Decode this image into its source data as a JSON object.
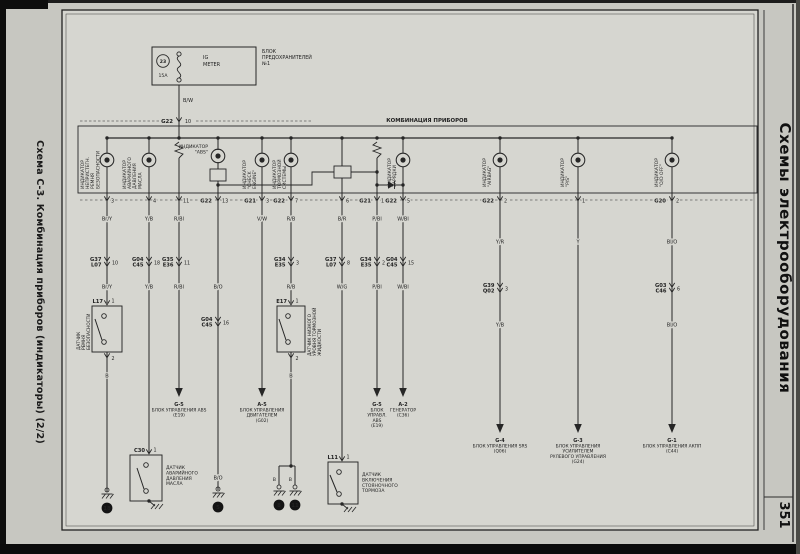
{
  "page": {
    "left_caption": "Схема С-3. Комбинация приборов (индикаторы) (2/2)",
    "right_caption": "Схемы электрооборудования",
    "page_number": "351"
  },
  "colors": {
    "paper": "#c7c7c1",
    "sheet": "#d6d6d0",
    "ink": "#262626"
  },
  "fuse_box": {
    "label_lines": [
      "БЛОК",
      "ПРЕДОХРАНИТЕЛЕЙ",
      "№1"
    ],
    "fuse_id": "23",
    "fuse_rating": "15A",
    "name_lines": [
      "IG",
      "METER"
    ],
    "wire_color": "B/W",
    "connector": "G22",
    "pin": "10"
  },
  "cluster": {
    "label": "КОМБИНАЦИЯ ПРИБОРОВ",
    "indicators": [
      {
        "id": "seatbelt",
        "lines": [
          "ИНДИКАТОР",
          "НЕПРИСТЕГН.",
          "РЕМНЯ",
          "БЕЗОПАСНОСТИ"
        ]
      },
      {
        "id": "oil",
        "lines": [
          "ИНДИКАТОР",
          "АВАРИЙНОГО",
          "ДАВЛЕНИЯ",
          "МАСЛА"
        ]
      },
      {
        "id": "abs",
        "lines": [
          "ИНДИКАТОР",
          "\"ABS\""
        ]
      },
      {
        "id": "check-engine",
        "lines": [
          "ИНДИКАТОР",
          "\"CHECK",
          "ENGINE\""
        ]
      },
      {
        "id": "brake",
        "lines": [
          "ИНДИКАТОР",
          "ТОРМОЗНОЙ",
          "СИСТЕМЫ"
        ]
      },
      {
        "id": "charge",
        "lines": [
          "ИНДИКАТОР",
          "ЗАРЯДКИ"
        ]
      },
      {
        "id": "airbag",
        "lines": [
          "ИНДИКАТОР",
          "\"AIRBAG\""
        ]
      },
      {
        "id": "power-steering",
        "lines": [
          "ИНДИКАТОР",
          "\"P/S\""
        ]
      },
      {
        "id": "od-off",
        "lines": [
          "ИНДИКАТОР",
          "\"O/D OFF\""
        ]
      }
    ]
  },
  "columns": [
    {
      "id": "c1",
      "pin": "3",
      "wire_color_top": "Br/Y",
      "mid_connector": {
        "codes": [
          "G37",
          "L07"
        ],
        "pin": "10"
      },
      "wire_color_mid": "Br/Y",
      "component": {
        "code": "L17",
        "pin_top": "1",
        "pin_bottom": "2",
        "label_lines": [
          "ДАТЧИК",
          "РЕМНЯ",
          "БЕЗОПАСНОСТИ"
        ]
      },
      "wire_color_after": "B",
      "termination": {
        "type": "ground",
        "id": "18"
      }
    },
    {
      "id": "c2",
      "pin": "4",
      "wire_color_top": "Y/B",
      "mid_connector": {
        "codes": [
          "G04",
          "C45"
        ],
        "pin": "18"
      },
      "wire_color_mid": "Y/B",
      "component": {
        "code": "C30",
        "pin_top": "1",
        "label_lines": [
          "ДАТЧИК",
          "АВАРИЙНОГО",
          "ДАВЛЕНИЯ",
          "МАСЛА"
        ]
      },
      "termination": {
        "type": "chassis-ground"
      }
    },
    {
      "id": "c3",
      "pin": "11",
      "wire_color_top": "R/Bl",
      "mid_connector": {
        "codes": [
          "G35",
          "E36"
        ],
        "pin": "11"
      },
      "wire_color_mid": "R/Bl",
      "termination": {
        "type": "arrow",
        "lines": [
          "G-5",
          "БЛОК УПРАВЛЕНИЯ ABS",
          "(E19)"
        ]
      }
    },
    {
      "id": "c4",
      "pin_connector": "G22",
      "pin": "13",
      "wire_color_mid": "B/O",
      "mid_connector": {
        "codes": [
          "G04",
          "C45"
        ],
        "pin": "16"
      },
      "wire_color_after": "B/O",
      "termination": {
        "type": "ground",
        "id": "5"
      }
    },
    {
      "id": "c5",
      "pin_connector": "G21",
      "pin": "3",
      "wire_color_top": "V/W",
      "termination": {
        "type": "arrow",
        "lines": [
          "A-5",
          "БЛОК УПРАВЛЕНИЯ",
          "ДВИГАТЕЛЕМ",
          "(G02)"
        ]
      }
    },
    {
      "id": "c6",
      "pin_connector": "G22",
      "pin": "7",
      "wire_color_top": "R/B",
      "mid_connector": {
        "codes": [
          "G34",
          "E35"
        ],
        "pin": "3"
      },
      "wire_color_mid": "R/B",
      "component": {
        "code": "E17",
        "pin_top": "1",
        "pin_bottom": "2",
        "label_lines": [
          "ДАТЧИК НИЗКОГО",
          "УРОВНЯ ТОРМОЗНОЙ",
          "ЖИДКОСТИ"
        ]
      },
      "wire_color_after": "B",
      "termination": {
        "type": "split-ground",
        "branch_color": "B",
        "ids": [
          "8",
          "11"
        ]
      }
    },
    {
      "id": "c7",
      "pin": "6",
      "wire_color_top": "B/R",
      "mid_connector": {
        "codes": [
          "G37",
          "L07"
        ],
        "pin": "8"
      },
      "wire_color_mid": "W/G",
      "component": {
        "code": "L11",
        "pin_top": "1",
        "label_lines": [
          "ДАТЧИК",
          "ВКЛЮЧЕНИЯ",
          "СТОЯНОЧНОГО",
          "ТОРМОЗА"
        ]
      },
      "termination": {
        "type": "chassis-ground"
      }
    },
    {
      "id": "c8",
      "pin_connector": "G21",
      "pin": "10",
      "wire_color_top": "P/Bl",
      "mid_connector": {
        "codes": [
          "G34",
          "E35"
        ],
        "pin": "2"
      },
      "wire_color_mid": "P/Bl",
      "termination": {
        "type": "arrow",
        "lines": [
          "G-5",
          "БЛОК",
          "УПРАВЛ.",
          "ABS",
          "(E19)"
        ]
      }
    },
    {
      "id": "c9",
      "pin_connector": "G22",
      "pin": "5",
      "wire_color_top": "W/Bl",
      "mid_connector": {
        "codes": [
          "G04",
          "C45"
        ],
        "pin": "15"
      },
      "wire_color_mid": "W/Bl",
      "termination": {
        "type": "arrow",
        "lines": [
          "A-2",
          "ГЕНЕРАТОР",
          "(C36)"
        ]
      }
    },
    {
      "id": "c10",
      "pin_connector": "G22",
      "pin": "2",
      "wire_color_top": "Y/R",
      "mid_connector": {
        "codes": [
          "G39",
          "Q02"
        ],
        "pin": "3"
      },
      "wire_color_mid": "Y/B",
      "termination": {
        "type": "arrow",
        "lines": [
          "G-4",
          "БЛОК УПРАВЛЕНИЯ SRS",
          "(Q06)"
        ]
      }
    },
    {
      "id": "c11",
      "pin": "1",
      "wire_color_top": "Y",
      "termination": {
        "type": "arrow",
        "lines": [
          "G-3",
          "БЛОК УПРАВЛЕНИЯ",
          "УСИЛИТЕЛЕМ",
          "РУЛЕВОГО УПРАВЛЕНИЯ",
          "(G24)"
        ]
      }
    },
    {
      "id": "c12",
      "pin_connector": "G20",
      "pin": "2",
      "wire_color_top": "Bl/O",
      "mid_connector": {
        "codes": [
          "G03",
          "C46"
        ],
        "pin": "6"
      },
      "wire_color_mid": "Bl/O",
      "termination": {
        "type": "arrow",
        "lines": [
          "G-1",
          "БЛОК УПРАВЛЕНИЯ АКПП",
          "(C44)"
        ]
      }
    }
  ]
}
